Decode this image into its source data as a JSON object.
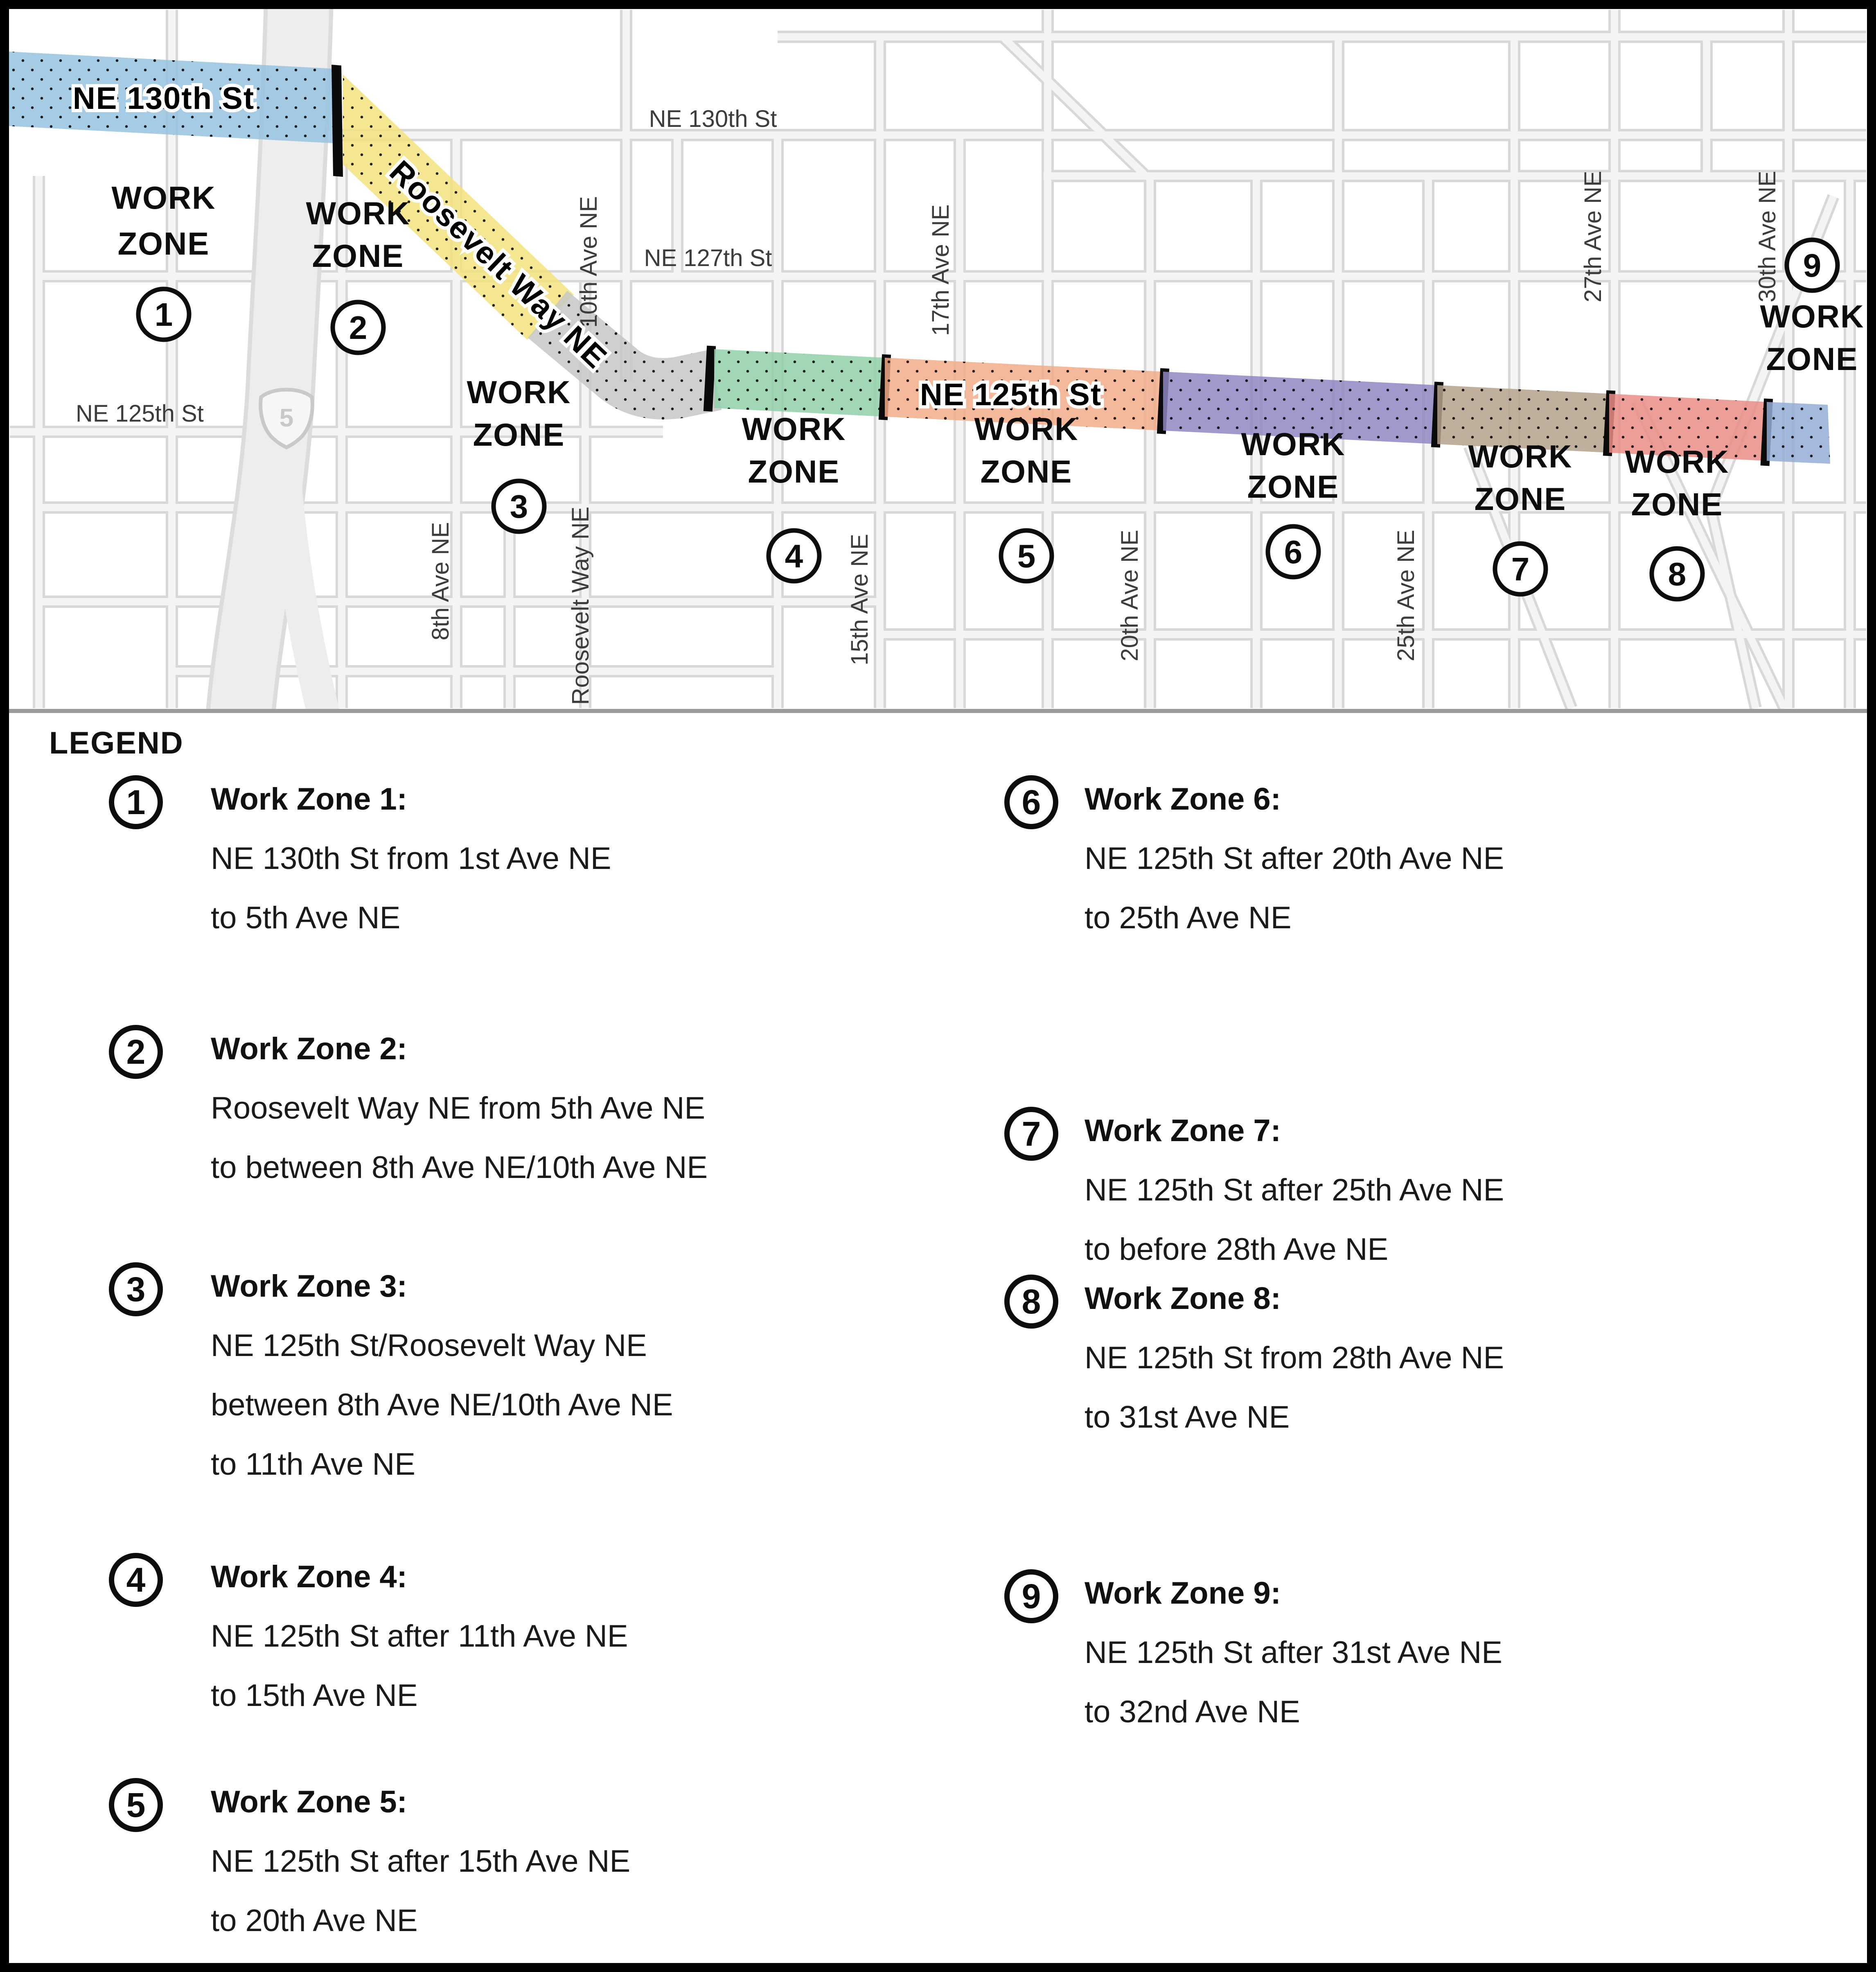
{
  "map": {
    "zone_word1": "WORK",
    "zone_word2": "ZONE",
    "i5": "5",
    "band_labels": {
      "ne130th": "NE 130th St",
      "roosevelt": "Roosevelt Way NE",
      "ne125th": "NE 125th St"
    },
    "street_labels": {
      "ne130th": "NE 130th St",
      "ne127th": "NE 127th St",
      "ne125th": "NE 125th St",
      "ave8": "8th Ave NE",
      "roosevelt_s": "Roosevelt Way NE",
      "ave10": "10th Ave NE",
      "ave15": "15th Ave NE",
      "ave17": "17th Ave NE",
      "ave20": "20th Ave NE",
      "ave25": "25th Ave NE",
      "ave27": "27th Ave NE",
      "ave30": "30th Ave NE"
    },
    "zones": [
      {
        "number": "1",
        "color": "#96c3e0"
      },
      {
        "number": "2",
        "color": "#f3e37f"
      },
      {
        "number": "3",
        "color": "#c7c7c7"
      },
      {
        "number": "4",
        "color": "#92d0a9"
      },
      {
        "number": "5",
        "color": "#f2ab8a"
      },
      {
        "number": "6",
        "color": "#9187c3"
      },
      {
        "number": "7",
        "color": "#b4a28c"
      },
      {
        "number": "8",
        "color": "#ea8d87"
      },
      {
        "number": "9",
        "color": "#94add6"
      }
    ]
  },
  "legend": {
    "heading": "LEGEND",
    "items": [
      {
        "number": "1",
        "title": "Work Zone 1:",
        "lines": [
          "NE 130th St from 1st Ave NE",
          "to 5th Ave NE"
        ]
      },
      {
        "number": "2",
        "title": "Work Zone 2:",
        "lines": [
          "Roosevelt Way NE from 5th Ave NE",
          "to between 8th Ave NE/10th Ave NE"
        ]
      },
      {
        "number": "3",
        "title": "Work Zone 3:",
        "lines": [
          "NE 125th St/Roosevelt Way NE",
          "between 8th Ave NE/10th Ave NE",
          "to 11th Ave NE"
        ]
      },
      {
        "number": "4",
        "title": "Work Zone 4:",
        "lines": [
          "NE 125th St after 11th Ave NE",
          "to 15th Ave NE"
        ]
      },
      {
        "number": "5",
        "title": "Work Zone 5:",
        "lines": [
          "NE 125th St after 15th Ave NE",
          "to 20th Ave NE"
        ]
      },
      {
        "number": "6",
        "title": "Work Zone 6:",
        "lines": [
          "NE 125th St after 20th Ave NE",
          "to 25th Ave NE"
        ]
      },
      {
        "number": "7",
        "title": "Work Zone 7:",
        "lines": [
          "NE 125th St after 25th Ave NE",
          "to before 28th Ave NE"
        ]
      },
      {
        "number": "8",
        "title": "Work Zone 8:",
        "lines": [
          "NE 125th St from 28th Ave NE",
          "to 31st Ave NE"
        ]
      },
      {
        "number": "9",
        "title": "Work Zone 9:",
        "lines": [
          "NE 125th St after 31st Ave NE",
          "to 32nd Ave NE"
        ]
      }
    ]
  }
}
